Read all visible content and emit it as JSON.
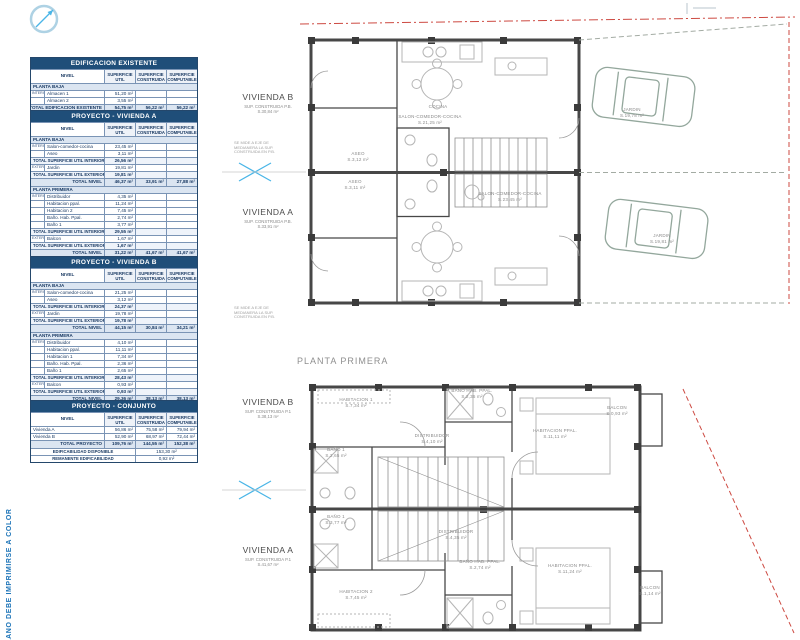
{
  "sheet": {
    "vertical_note": "PLANO DEBE IMPRIMIRSE A COLOR",
    "colors": {
      "table_header_blue": "#1f4e79",
      "table_shade_blue": "#dbe5f1",
      "grand_row_blue": "#9fbcdc",
      "section_marker_cyan": "#49b5e7",
      "boundary_red": "#cd4a42",
      "note_blue": "#1c74b8",
      "wall_gray": "#474747"
    },
    "icons": [
      "north-arrow-icon",
      "section-cut-icon"
    ]
  },
  "tables": [
    {
      "id": "edificacion-existente",
      "title": "EDIFICACION EXISTENTE",
      "top": 57,
      "headers": {
        "nivel": "NIVEL",
        "util": [
          "SUPERFICIE",
          "UTIL"
        ],
        "cons": [
          "SUPERFICIE",
          "CONSTRUIDA"
        ],
        "comp": [
          "SUPERFICIE",
          "COMPUTABLE"
        ]
      },
      "rows": [
        {
          "t": "sec",
          "label": "PLANTA BAJA"
        },
        {
          "t": "item",
          "gutter": "INTERIOR",
          "label": "Almacen 1",
          "util": "51,20 m²"
        },
        {
          "t": "item",
          "label": "Almacen 2",
          "util": "3,55 m²"
        },
        {
          "t": "tot",
          "label": "TOTAL EDIFICACION EXISTENTE",
          "util": "54,75 m²",
          "cons": "56,22 m²",
          "comp": "56,22 m²"
        }
      ]
    },
    {
      "id": "proyecto-vivienda-a",
      "title": "PROYECTO - VIVIENDA A",
      "top": 110,
      "headers": {
        "nivel": "NIVEL",
        "util": [
          "SUPERFICIE",
          "UTIL"
        ],
        "cons": [
          "SUPERFICIE",
          "CONSTRUIDA"
        ],
        "comp": [
          "SUPERFICIE",
          "COMPUTABLE"
        ]
      },
      "rows": [
        {
          "t": "sec",
          "label": "PLANTA BAJA"
        },
        {
          "t": "item",
          "gutter": "INTERIOR",
          "label": "Salon-comedor-cocina",
          "util": "23,45 m²"
        },
        {
          "t": "item",
          "label": "Aseo",
          "util": "3,11 m²"
        },
        {
          "t": "sub",
          "label": "TOTAL SUPERFICIE UTIL INTERIOR",
          "util": "26,56 m²"
        },
        {
          "t": "item",
          "gutter": "EXTERIOR",
          "label": "Jardin",
          "util": "19,81 m²"
        },
        {
          "t": "sub",
          "label": "TOTAL SUPERFICIE UTIL EXTERIOR",
          "util": "19,81 m²"
        },
        {
          "t": "tot",
          "label": "TOTAL NIVEL",
          "util": "46,37 m²",
          "cons": "33,91 m²",
          "comp": "27,88 m²"
        },
        {
          "t": "sec",
          "label": "PLANTA PRIMERA"
        },
        {
          "t": "item",
          "gutter": "INTERIOR",
          "label": "Distribuidor",
          "util": "4,35 m²"
        },
        {
          "t": "item",
          "label": "Habitacion ppal.",
          "util": "11,24 m²"
        },
        {
          "t": "item",
          "label": "Habitacion 2",
          "util": "7,45 m²"
        },
        {
          "t": "item",
          "label": "Baño. Hab. Ppal.",
          "util": "2,74 m²"
        },
        {
          "t": "item",
          "label": "Baño 1",
          "util": "3,77 m²"
        },
        {
          "t": "sub",
          "label": "TOTAL SUPERFICIE UTIL INTERIOR",
          "util": "29,55 m²"
        },
        {
          "t": "item",
          "gutter": "EXTERIOR",
          "label": "Balcon",
          "util": "1,67 m²"
        },
        {
          "t": "sub",
          "label": "TOTAL SUPERFICIE UTIL EXTERIOR",
          "util": "1,67 m²"
        },
        {
          "t": "tot",
          "label": "TOTAL NIVEL",
          "util": "31,22 m²",
          "cons": "41,67 m²",
          "comp": "41,67 m²"
        },
        {
          "t": "grand",
          "label": "TOTAL VIVIENDA PROYECTO",
          "util": "77,59 m²",
          "cons": "75,58 m²",
          "comp": "69,55 m²"
        }
      ]
    },
    {
      "id": "proyecto-vivienda-b",
      "title": "PROYECTO - VIVIENDA B",
      "top": 256,
      "headers": {
        "nivel": "NIVEL",
        "util": [
          "SUPERFICIE",
          "UTIL"
        ],
        "cons": [
          "SUPERFICIE",
          "CONSTRUIDA"
        ],
        "comp": [
          "SUPERFICIE",
          "COMPUTABLE"
        ]
      },
      "rows": [
        {
          "t": "sec",
          "label": "PLANTA BAJA"
        },
        {
          "t": "item",
          "gutter": "INTERIOR",
          "label": "Salon-comedor-cocina",
          "util": "21,25 m²"
        },
        {
          "t": "item",
          "label": "Aseo",
          "util": "3,12 m²"
        },
        {
          "t": "sub",
          "label": "TOTAL SUPERFICIE UTIL INTERIOR",
          "util": "24,37 m²"
        },
        {
          "t": "item",
          "gutter": "EXTERIOR",
          "label": "Jardin",
          "util": "19,78 m²"
        },
        {
          "t": "sub",
          "label": "TOTAL SUPERFICIE UTIL EXTERIOR",
          "util": "19,78 m²"
        },
        {
          "t": "tot",
          "label": "TOTAL NIVEL",
          "util": "44,15 m²",
          "cons": "30,84 m²",
          "comp": "34,21 m²"
        },
        {
          "t": "sec",
          "label": "PLANTA PRIMERA"
        },
        {
          "t": "item",
          "gutter": "INTERIOR",
          "label": "Distribuidor",
          "util": "4,10 m²"
        },
        {
          "t": "item",
          "label": "Habitacion ppal.",
          "util": "11,11 m²"
        },
        {
          "t": "item",
          "label": "Habitacion 1",
          "util": "7,34 m²"
        },
        {
          "t": "item",
          "label": "Baño. Hab. Ppal.",
          "util": "2,36 m²"
        },
        {
          "t": "item",
          "label": "Baño 1",
          "util": "2,65 m²"
        },
        {
          "t": "sub",
          "label": "TOTAL SUPERFICIE UTIL INTERIOR",
          "util": "28,43 m²"
        },
        {
          "t": "item",
          "gutter": "EXTERIOR",
          "label": "Balcon",
          "util": "0,93 m²"
        },
        {
          "t": "sub",
          "label": "TOTAL SUPERFICIE UTIL EXTERIOR",
          "util": "0,93 m²"
        },
        {
          "t": "tot",
          "label": "TOTAL NIVEL",
          "util": "29,36 m²",
          "cons": "38,13 m²",
          "comp": "38,13 m²"
        },
        {
          "t": "grand",
          "label": "TOTAL VIVIENDA PROYECTO",
          "util": "52,90 m²",
          "cons": "68,97 m²",
          "comp": "72,44 m²"
        }
      ]
    },
    {
      "id": "proyecto-conjunto",
      "title": "PROYECTO - CONJUNTO",
      "top": 400,
      "headers": {
        "nivel": "NIVEL",
        "util": [
          "SUPERFICIE",
          "UTIL"
        ],
        "cons": [
          "SUPERFICIE",
          "CONSTRUIDA"
        ],
        "comp": [
          "SUPERFICIE",
          "COMPUTABLE"
        ]
      },
      "rows": [
        {
          "t": "vrow",
          "label": "Vivienda A",
          "util": "56,86 m²",
          "cons": "75,58 m²",
          "comp": "79,94 m²"
        },
        {
          "t": "vrow",
          "label": "Vivienda B",
          "util": "52,90 m²",
          "cons": "68,97 m²",
          "comp": "72,44 m²"
        },
        {
          "t": "tot",
          "label": "TOTAL PROYECTO",
          "util": "109,76 m²",
          "cons": "144,55 m²",
          "comp": "152,38 m²"
        },
        {
          "t": "wide",
          "label": "EDIFICABILIDAD DISPONIBLE",
          "value": "153,30 m²"
        },
        {
          "t": "wide",
          "label": "REMANENTE EDIFICABILIDAD",
          "value": "0,92 m²"
        }
      ]
    }
  ],
  "plans": {
    "bottom_title": "PLANTA PRIMERA",
    "top": {
      "dwellings": [
        {
          "title": "VIVIENDA B",
          "sub": [
            "SUP. CONSTRUIDA P.B.",
            "S.30,84 m²"
          ],
          "x": 232,
          "y": 92
        },
        {
          "title": "VIVIENDA A",
          "sub": [
            "SUP. CONSTRUIDA P.B.",
            "S.33,91 m²"
          ],
          "x": 232,
          "y": 207
        }
      ],
      "notes": [
        {
          "lines": [
            "SE MIDE A EJE DE",
            "MEDIANERA LA SUP.",
            "CONSTRUIDA EN P.B."
          ],
          "x": 234,
          "y": 141
        },
        {
          "lines": [
            "SE MIDE A EJE DE",
            "MEDIANERA LA SUP.",
            "CONSTRUIDA EN P.B."
          ],
          "x": 234,
          "y": 306
        }
      ],
      "rooms": [
        {
          "lines": [
            "ASEO",
            "S.3,12 m²"
          ],
          "x": 358,
          "y": 151
        },
        {
          "lines": [
            "COCINA"
          ],
          "x": 438,
          "y": 104
        },
        {
          "lines": [
            "SALON-COMEDOR-COCINA",
            "S.21,25 m²"
          ],
          "x": 430,
          "y": 114
        },
        {
          "lines": [
            "ASEO",
            "S.3,11 m²"
          ],
          "x": 355,
          "y": 179
        },
        {
          "lines": [
            "SALON-COMEDOR-COCINA",
            "S.23,45 m²"
          ],
          "x": 510,
          "y": 191
        },
        {
          "lines": [
            "JARDIN",
            "S.19,78 m²"
          ],
          "x": 632,
          "y": 107
        },
        {
          "lines": [
            "JARDIN",
            "S.19,81 m²"
          ],
          "x": 662,
          "y": 233
        }
      ]
    },
    "bottom": {
      "dwellings": [
        {
          "title": "VIVIENDA B",
          "sub": [
            "SUP. CONSTRUIDA P.1",
            "S.38,13 m²"
          ],
          "x": 232,
          "y": 397
        },
        {
          "title": "VIVIENDA A",
          "sub": [
            "SUP. CONSTRUIDA P.1",
            "S.41,67 m²"
          ],
          "x": 232,
          "y": 545
        }
      ],
      "notes": [],
      "rooms": [
        {
          "lines": [
            "HABITACION 1",
            "S.7,34 m²"
          ],
          "x": 356,
          "y": 397
        },
        {
          "lines": [
            "BAÑO HAB. PPAL.",
            "S.2,36 m²"
          ],
          "x": 472,
          "y": 388
        },
        {
          "lines": [
            "HABITACION PPAL.",
            "S.11,11 m²"
          ],
          "x": 555,
          "y": 428
        },
        {
          "lines": [
            "BALCON",
            "S.0,93 m²"
          ],
          "x": 617,
          "y": 405
        },
        {
          "lines": [
            "DISTRIBUIDOR",
            "S.4,10 m²"
          ],
          "x": 432,
          "y": 433
        },
        {
          "lines": [
            "BAÑO 1",
            "S.2,65 m²"
          ],
          "x": 336,
          "y": 447
        },
        {
          "lines": [
            "BAÑO 1",
            "S.3,77 m²"
          ],
          "x": 336,
          "y": 514
        },
        {
          "lines": [
            "DISTRIBUIDOR",
            "S.4,35 m²"
          ],
          "x": 456,
          "y": 529
        },
        {
          "lines": [
            "BAÑO HAB. PPAL.",
            "S.2,74 m²"
          ],
          "x": 480,
          "y": 559
        },
        {
          "lines": [
            "HABITACION 2",
            "S.7,45 m²"
          ],
          "x": 356,
          "y": 589
        },
        {
          "lines": [
            "HABITACION PPAL.",
            "S.11,24 m²"
          ],
          "x": 570,
          "y": 563
        },
        {
          "lines": [
            "BALCON",
            "S.1,14 m²"
          ],
          "x": 650,
          "y": 585
        }
      ]
    }
  }
}
